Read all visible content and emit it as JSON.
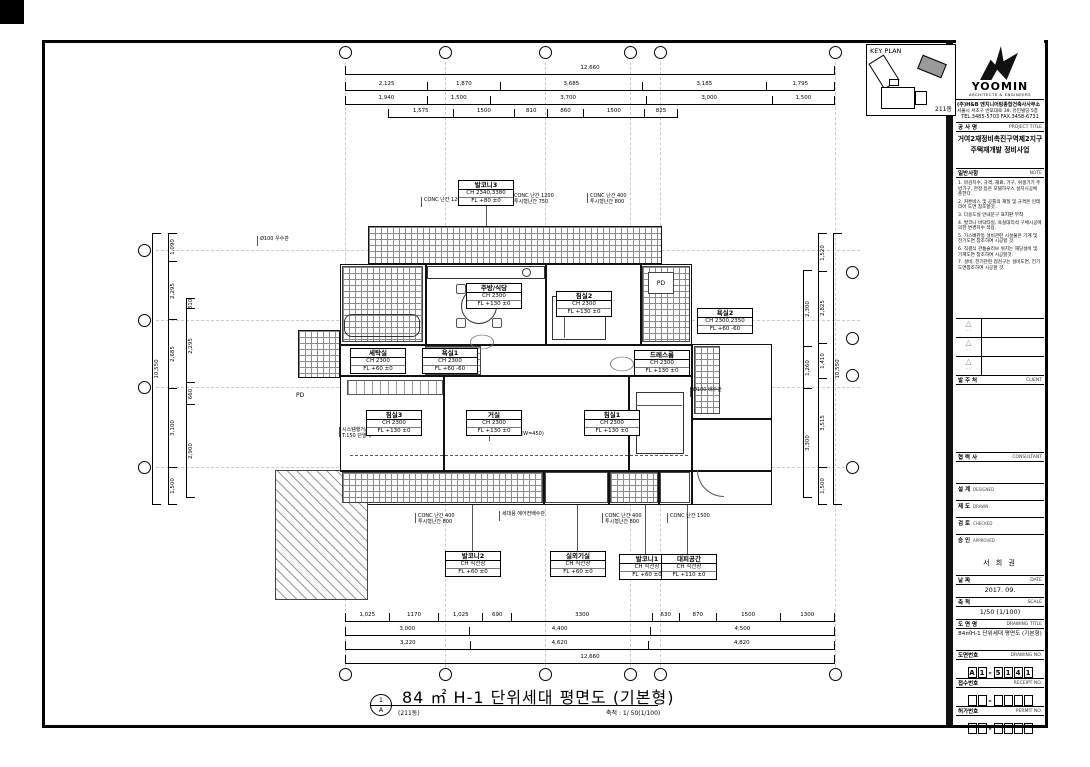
{
  "sheet": {
    "key_plan_title": "KEY PLAN",
    "key_plan_building": "211동"
  },
  "title_block": {
    "logo_name": "YOOMIN",
    "logo_sub": "ARCHITECTS & ENGINEERS",
    "company": "(주)H&B 엔지니어링종합건축사사무소",
    "address": "서울시 서초구 반포대로 39, 유민빌딩 5층",
    "tel": "TEL.3485-5703  FAX.3458-6731",
    "project_label_ko": "공 사 명",
    "project_label_en": "PROJECT TITLE",
    "project_name_line1": "거여2재정비촉진구역제2지구",
    "project_name_line2": "주택재개발 정비사업",
    "note_label_ko": "일반사항",
    "note_label_en": "NOTE",
    "notes": [
      "마감치수, 규격, 재료, 기구, 위생기기 주방가구, 천정 등은 모델하우스 설치시공에 준한다.",
      "커튼박스 및 공틀의 재질 및 규격은 인테리어 도면 참조할것.",
      "다용도실 안내문구 표지판 부착",
      "발코니 바닥타일, 욕실대리석 구체시공에 의한 변경치수 적용.",
      "가스배관등 설비관련 시설물은 기계 및 전기도면 참조하여 시공할 것.",
      "직결식 관통슬리브 위치는 해당설비 및 기계도면 참조하여 시공할것.",
      "설비, 전기관련 점검구는 설비도면, 전기도면참조하여 시공할 것."
    ],
    "section1_ko": "발 주 처",
    "section1_en": "CLIENT",
    "section2_ko": "협 력 사",
    "section2_en": "CONSULTANT",
    "fields": [
      {
        "ko": "설 계",
        "en": "DESIGNED"
      },
      {
        "ko": "제 도",
        "en": "DRAWN"
      },
      {
        "ko": "검 토",
        "en": "CHECKED"
      },
      {
        "ko": "승 인",
        "en": "APPROVED"
      }
    ],
    "approver": "서 희 권",
    "date_ko": "날 짜",
    "date_en": "DATE",
    "date_value": "2017. 09.",
    "scale_ko": "축 척",
    "scale_en": "SCALE",
    "scale_value": "1/50 (1/100)",
    "dwg_title_ko": "도 면 명",
    "dwg_title_en": "DRAWING TITLE",
    "dwg_title_value": "84㎡H-1 단위세대 평면도 (기본형)",
    "dwg_no_ko": "도면번호",
    "dwg_no_en": "DRAWING NO.",
    "dwg_no_chars": [
      "A",
      "1",
      "-",
      "5",
      "1",
      "4",
      "1"
    ],
    "recv_ko": "접수번호",
    "recv_en": "RECEIPT NO.",
    "recv_chars": [
      "",
      "",
      "-",
      "",
      "",
      "",
      ""
    ],
    "permit_ko": "허가번호",
    "permit_en": "PERMIT NO.",
    "permit_chars": [
      "",
      "",
      "-",
      "",
      "",
      "",
      ""
    ]
  },
  "drawing": {
    "title": "84 ㎡ H-1 단위세대 평면도 (기본형)",
    "subtitle": "(211동)",
    "scale_note": "축척 : 1/ 50(1/100)",
    "marker_top": "1",
    "marker_bottom": "A",
    "pd_label": "PD",
    "rooms": [
      {
        "name": "발코니3",
        "ch": "CH 2340,3380",
        "fl": "FL +80  ±0"
      },
      {
        "name": "주방/식당",
        "ch": "CH 2300",
        "fl": "FL +130  ±0"
      },
      {
        "name": "침실2",
        "ch": "CH 2300",
        "fl": "FL +130  ±0"
      },
      {
        "name": "욕실2",
        "ch": "CH 2300,2350",
        "fl": "FL +60  -60"
      },
      {
        "name": "드레스룸",
        "ch": "CH 2300",
        "fl": "FL +130  ±0"
      },
      {
        "name": "세탁실",
        "ch": "CH 2300",
        "fl": "FL +60  ±0"
      },
      {
        "name": "욕실1",
        "ch": "CH 2300",
        "fl": "FL +60  -60"
      },
      {
        "name": "침실3",
        "ch": "CH 2300",
        "fl": "FL +130  ±0"
      },
      {
        "name": "거실",
        "ch": "CH 2300",
        "fl": "FL +130  ±0"
      },
      {
        "name": "침실1",
        "ch": "CH 2300",
        "fl": "FL +130  ±0"
      },
      {
        "name": "발코니2",
        "ch": "CH 직천장",
        "fl": "FL +60  ±0"
      },
      {
        "name": "실외기실",
        "ch": "CH 직천장",
        "fl": "FL +60  ±0"
      },
      {
        "name": "발코니1",
        "ch": "CH 직천장",
        "fl": "FL +60  ±0"
      },
      {
        "name": "대피공간",
        "ch": "CH 직천장",
        "fl": "FL +110  ±0"
      }
    ],
    "annotations": [
      "CONC 난간 1200",
      "CONC 난간 1200\n투시형난간 750",
      "CONC 난간 400\n투시형난간 800",
      "Ø100 우수관",
      "시스템행거/자동확산소화기\nT:150 단열재",
      "붙박이장 설치(W=450)",
      "Ø100 배수관",
      "CONC 난간 400\n투시형난간 800",
      "세대용 에어컨배수관",
      "CONC 난간 400\n투시형난간 800",
      "CONC 난간 1500"
    ],
    "dims": {
      "top": {
        "overall": "12,660",
        "row1": [
          "2,125",
          "1,870",
          "3,685",
          "3,185",
          "1,795"
        ],
        "row2": [
          "1,940",
          "1,500",
          "3,700",
          "3,000",
          "1,500"
        ],
        "row3": [
          "1,575",
          "1500",
          "810",
          "860",
          "1500",
          "825"
        ]
      },
      "bottom": {
        "row1": [
          "1,025",
          "1170",
          "1,025",
          "690",
          "3300",
          "630",
          "870",
          "1500",
          "1300"
        ],
        "row2": [
          "3,000",
          "4,400",
          "4,500"
        ],
        "row3": [
          "3,220",
          "4,620",
          "4,820"
        ],
        "overall": "12,660"
      },
      "left": {
        "overall": "10,550",
        "outer": [
          "1,090",
          "2,295",
          "2,685",
          "3,100",
          "1,500"
        ],
        "inner": [
          "310",
          "2,295",
          "660",
          "2,900"
        ]
      },
      "right": {
        "overall": "10,550",
        "outer": [
          "1,520",
          "2,825",
          "1,410",
          "3,515",
          "1,500"
        ],
        "inner": [
          "2,300",
          "1,260",
          "3,300"
        ]
      }
    }
  }
}
